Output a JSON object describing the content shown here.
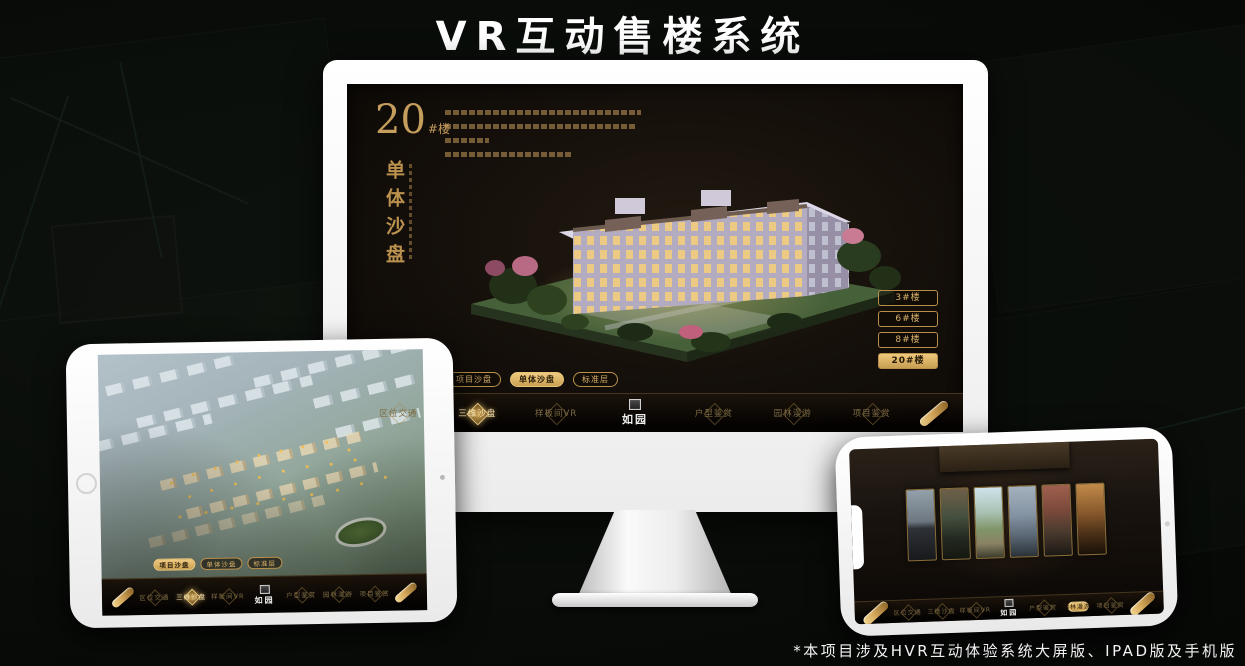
{
  "page": {
    "title": "VR互动售楼系统",
    "footnote": "*本项目涉及HVR互动体验系统大屏版、IPAD版及手机版"
  },
  "colors": {
    "gold": "#cda35f",
    "gold_bright": "#eec87c",
    "screen_bg": "#16110c",
    "background": "#0a0d0a"
  },
  "nav": {
    "items": [
      "区位交通",
      "三维沙盘",
      "样板间VR",
      "户型鉴赏",
      "园林漫游",
      "项目鉴赏"
    ],
    "logo": "如园"
  },
  "monitor": {
    "headline_number": "20",
    "headline_suffix": "#楼",
    "vertical_title": "单体沙盘",
    "floor_buttons": [
      "3#楼",
      "6#楼",
      "8#楼",
      "20#楼"
    ],
    "active_floor": "20#楼",
    "sub_tabs": [
      "项目沙盘",
      "单体沙盘",
      "标准层"
    ],
    "active_sub_tab": "单体沙盘",
    "active_nav": "三维沙盘"
  },
  "ipad": {
    "sub_tabs": [
      "项目沙盘",
      "单体沙盘",
      "标准层"
    ],
    "active_sub_tab": "项目沙盘",
    "active_nav": "三维沙盘"
  },
  "phone": {
    "active_nav": "园林漫游",
    "gallery_card_count": "6"
  }
}
